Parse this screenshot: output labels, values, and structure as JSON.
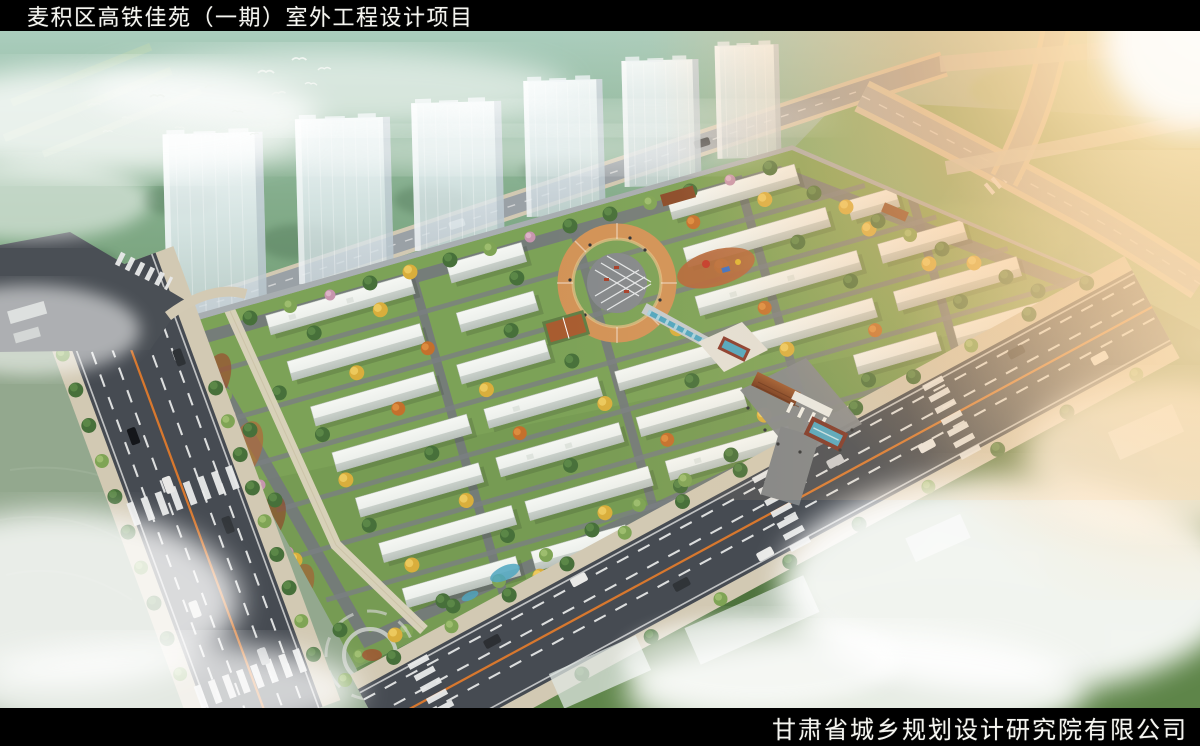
{
  "header": {
    "title": "麦积区高铁佳苑（一期）室外工程设计项目"
  },
  "footer": {
    "company": "甘肃省城乡规划设计研究院有限公司"
  },
  "colors": {
    "title_bar_bg": "#000000",
    "title_text": "#f5f5f0",
    "road_asphalt": "#464b52",
    "lane_marking": "#e9eaea",
    "center_line": "#e07a2c",
    "sidewalk": "#d2c9b3",
    "grass": "#7ca257",
    "hill_green": "#7fa98c",
    "field_green": "#5e8549",
    "tree_green": "#47703a",
    "tree_light": "#7fa455",
    "autumn_yellow": "#d9ae3c",
    "autumn_orange": "#c4702c",
    "tree_rust": "#a3512f",
    "blossom_pink": "#c795ae",
    "building_white": "#eef1ee",
    "tower_glass": "#e3edf2",
    "plaza_orange": "#d29357",
    "water_blue": "#4fa6c0",
    "gate_roof": "#8a4a28",
    "sun_glow": "#ffc98a",
    "mist_white": "#ffffff"
  }
}
